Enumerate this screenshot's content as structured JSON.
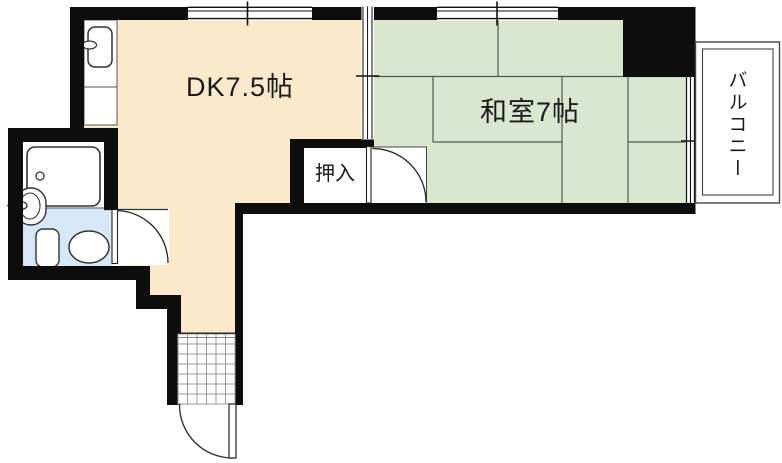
{
  "plan": {
    "type": "floor-plan",
    "rooms": {
      "dk": {
        "label": "DK7.5帖",
        "floor_color": "#FAE9CB"
      },
      "washitsu": {
        "label": "和室7帖",
        "floor_color": "#D9E6D0"
      },
      "oshiire": {
        "label": "押入"
      },
      "balcony": {
        "label": "バルコニー"
      },
      "bathroom": {
        "floor_color": "#D6E8F7"
      }
    },
    "fixtures": [
      "kitchen-counter",
      "kitchen-sink",
      "faucet",
      "bathtub",
      "wash-basin",
      "toilet",
      "entrance-tile",
      "entrance-door",
      "bath-door",
      "washitsu-door",
      "sliding-partition",
      "window-top-left",
      "window-top-right",
      "window-right"
    ],
    "colors": {
      "wall": "#0d0d0d",
      "tatami_line": "#4f5a4c",
      "tile_grid": "#999999",
      "outline": "#222222"
    }
  }
}
